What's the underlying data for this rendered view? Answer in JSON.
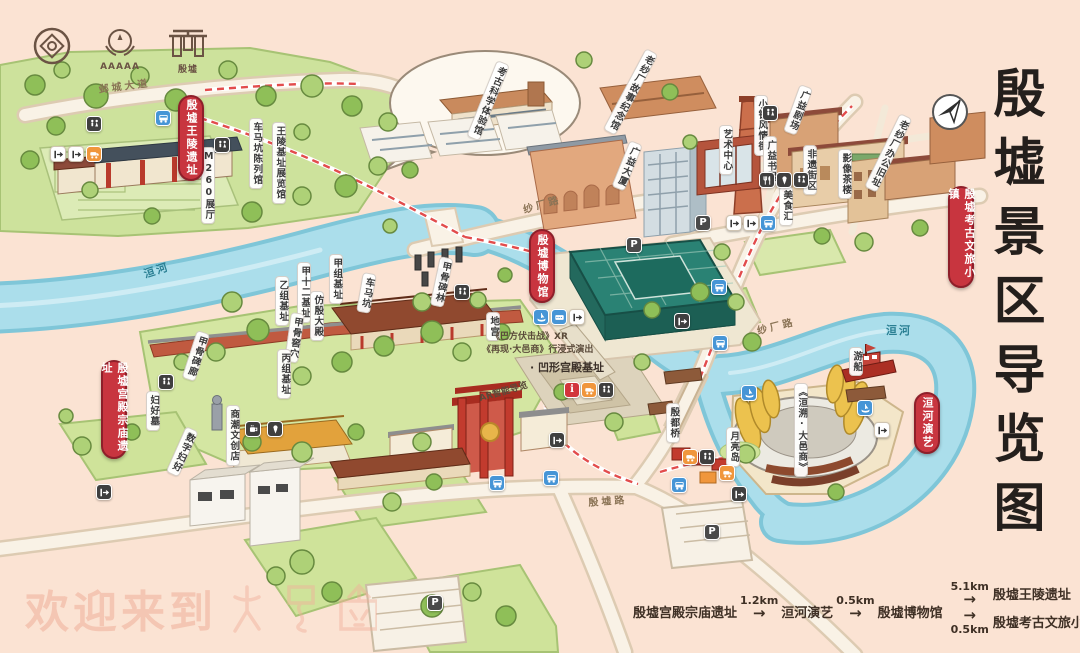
{
  "title": {
    "text": "殷墟景区导览图"
  },
  "logos": {
    "aaaaa": "AAAAA",
    "yinxu": "殷墟"
  },
  "badges": [
    {
      "id": "wangling",
      "text": "殷墟王陵遗址",
      "x": 178,
      "y": 95,
      "h": 82
    },
    {
      "id": "museum",
      "text": "殷墟博物馆",
      "x": 529,
      "y": 229,
      "h": 70
    },
    {
      "id": "town",
      "text": "殷墟考古文旅小镇",
      "x": 948,
      "y": 186,
      "h": 98
    },
    {
      "id": "palace",
      "text": "殷墟宫殿宗庙遗址",
      "x": 101,
      "y": 360,
      "h": 95
    },
    {
      "id": "show",
      "text": "洹河演艺",
      "x": 914,
      "y": 392,
      "h": 58
    }
  ],
  "map_labels": [
    {
      "text": "邺城大道",
      "x": 96,
      "y": 84,
      "mode": "road",
      "rot": -7
    },
    {
      "text": "车马坑陈列馆",
      "x": 249,
      "y": 118,
      "mode": "v"
    },
    {
      "text": "M260展厅",
      "x": 201,
      "y": 147,
      "mode": "v"
    },
    {
      "text": "王陵基址展览馆",
      "x": 272,
      "y": 122,
      "mode": "v"
    },
    {
      "text": "洹河",
      "x": 140,
      "y": 268,
      "mode": "river",
      "rot": -18
    },
    {
      "text": "甲组基址",
      "x": 329,
      "y": 254,
      "mode": "v"
    },
    {
      "text": "甲十二基址",
      "x": 297,
      "y": 262,
      "mode": "v"
    },
    {
      "text": "乙组基址",
      "x": 275,
      "y": 276,
      "mode": "v"
    },
    {
      "text": "仿殷大殿",
      "x": 310,
      "y": 291,
      "mode": "v"
    },
    {
      "text": "车马坑",
      "x": 363,
      "y": 272,
      "mode": "v",
      "rot": 10
    },
    {
      "text": "甲骨窖穴",
      "x": 291,
      "y": 312,
      "mode": "v",
      "rot": 8
    },
    {
      "text": "丙组基址",
      "x": 277,
      "y": 349,
      "mode": "v"
    },
    {
      "text": "甲骨碑林",
      "x": 440,
      "y": 256,
      "mode": "v",
      "rot": 12
    },
    {
      "text": "地宫",
      "x": 486,
      "y": 312,
      "mode": "v"
    },
    {
      "text": "《巴方伏击战》XR",
      "x": 489,
      "y": 331,
      "mode": "note"
    },
    {
      "text": "《再现·大邑商》行浸式演出",
      "x": 480,
      "y": 344,
      "mode": "note"
    },
    {
      "text": "· 凹形宫殿基址",
      "x": 528,
      "y": 360,
      "mode": "plain"
    },
    {
      "text": "AR智能导览",
      "x": 476,
      "y": 394,
      "mode": "note",
      "rot": -16
    },
    {
      "text": "甲骨碑廊",
      "x": 197,
      "y": 330,
      "mode": "v",
      "rot": 18
    },
    {
      "text": "妇好墓",
      "x": 146,
      "y": 391,
      "mode": "v"
    },
    {
      "text": "数字妇好",
      "x": 186,
      "y": 426,
      "mode": "v",
      "rot": 24
    },
    {
      "text": "商潮文创店",
      "x": 226,
      "y": 405,
      "mode": "v"
    },
    {
      "text": "纱厂路",
      "x": 520,
      "y": 205,
      "mode": "road",
      "rot": -16
    },
    {
      "text": "殷墟路",
      "x": 586,
      "y": 497,
      "mode": "road",
      "rot": -4
    },
    {
      "text": "考古科学体验馆",
      "x": 497,
      "y": 60,
      "mode": "v",
      "rot": 22
    },
    {
      "text": "老纱厂故事纪念馆",
      "x": 646,
      "y": 48,
      "mode": "v",
      "rot": 28
    },
    {
      "text": "广益大厦",
      "x": 630,
      "y": 140,
      "mode": "v",
      "rot": 22
    },
    {
      "text": "小镇风情街",
      "x": 754,
      "y": 95,
      "mode": "v"
    },
    {
      "text": "广益剧场",
      "x": 800,
      "y": 84,
      "mode": "v",
      "rot": 20
    },
    {
      "text": "艺术中心",
      "x": 719,
      "y": 125,
      "mode": "v"
    },
    {
      "text": "广益书屋",
      "x": 763,
      "y": 136,
      "mode": "v"
    },
    {
      "text": "非遗街区",
      "x": 803,
      "y": 145,
      "mode": "v"
    },
    {
      "text": "影像茶楼",
      "x": 838,
      "y": 149,
      "mode": "v"
    },
    {
      "text": "老纱厂办公旧址",
      "x": 900,
      "y": 113,
      "mode": "v",
      "rot": 26
    },
    {
      "text": "美食汇",
      "x": 779,
      "y": 186,
      "mode": "v"
    },
    {
      "text": "纱厂路",
      "x": 754,
      "y": 326,
      "mode": "road",
      "rot": -14
    },
    {
      "text": "洹河",
      "x": 884,
      "y": 323,
      "mode": "river"
    },
    {
      "text": "游船",
      "x": 849,
      "y": 347,
      "mode": "v"
    },
    {
      "text": "《洹溯·大邑商》",
      "x": 794,
      "y": 383,
      "mode": "v"
    },
    {
      "text": "月亮岛",
      "x": 726,
      "y": 427,
      "mode": "v"
    },
    {
      "text": "殷都桥",
      "x": 666,
      "y": 403,
      "mode": "v"
    }
  ],
  "icons": [
    {
      "type": "wc",
      "x": 86,
      "y": 116
    },
    {
      "type": "gate",
      "x": 50,
      "y": 146,
      "variant": "light"
    },
    {
      "type": "gate",
      "x": 68,
      "y": 146,
      "variant": "light"
    },
    {
      "type": "shuttle",
      "x": 86,
      "y": 146
    },
    {
      "type": "bus",
      "x": 155,
      "y": 110
    },
    {
      "type": "wc",
      "x": 214,
      "y": 137
    },
    {
      "type": "parking",
      "x": 626,
      "y": 237
    },
    {
      "type": "wc",
      "x": 454,
      "y": 284
    },
    {
      "type": "boat",
      "x": 533,
      "y": 309
    },
    {
      "type": "ticket",
      "x": 551,
      "y": 309
    },
    {
      "type": "gate",
      "x": 569,
      "y": 309,
      "variant": "light"
    },
    {
      "type": "gate",
      "x": 674,
      "y": 313,
      "variant": "dark"
    },
    {
      "type": "wc",
      "x": 158,
      "y": 374
    },
    {
      "type": "coffee",
      "x": 245,
      "y": 421
    },
    {
      "type": "dessert",
      "x": 267,
      "y": 421
    },
    {
      "type": "info",
      "x": 564,
      "y": 382
    },
    {
      "type": "shuttle",
      "x": 581,
      "y": 382
    },
    {
      "type": "wc",
      "x": 598,
      "y": 382
    },
    {
      "type": "gate",
      "x": 549,
      "y": 432,
      "variant": "dark"
    },
    {
      "type": "bus",
      "x": 543,
      "y": 470
    },
    {
      "type": "bus",
      "x": 489,
      "y": 475
    },
    {
      "type": "bus",
      "x": 711,
      "y": 279
    },
    {
      "type": "parking",
      "x": 695,
      "y": 215
    },
    {
      "type": "gate",
      "x": 726,
      "y": 215,
      "variant": "light"
    },
    {
      "type": "gate",
      "x": 743,
      "y": 215,
      "variant": "light"
    },
    {
      "type": "bus",
      "x": 760,
      "y": 215
    },
    {
      "type": "wc",
      "x": 762,
      "y": 105
    },
    {
      "type": "food",
      "x": 759,
      "y": 172
    },
    {
      "type": "dessert",
      "x": 776,
      "y": 172
    },
    {
      "type": "wc",
      "x": 793,
      "y": 172
    },
    {
      "type": "bus",
      "x": 712,
      "y": 335
    },
    {
      "type": "boat",
      "x": 741,
      "y": 385
    },
    {
      "type": "boat",
      "x": 857,
      "y": 400
    },
    {
      "type": "gate",
      "x": 874,
      "y": 422,
      "variant": "light"
    },
    {
      "type": "shuttle",
      "x": 682,
      "y": 449
    },
    {
      "type": "wc",
      "x": 699,
      "y": 449
    },
    {
      "type": "shuttle",
      "x": 719,
      "y": 465
    },
    {
      "type": "bus",
      "x": 671,
      "y": 477
    },
    {
      "type": "gate",
      "x": 731,
      "y": 486,
      "variant": "dark"
    },
    {
      "type": "parking",
      "x": 704,
      "y": 524
    },
    {
      "type": "parking",
      "x": 427,
      "y": 595
    },
    {
      "type": "gate",
      "x": 96,
      "y": 484,
      "variant": "dark"
    }
  ],
  "route_bar": {
    "arrow": "→",
    "stop1": "殷墟宫殿宗庙遗址",
    "dist1": "1.2km",
    "stop2": "洹河演艺",
    "dist2": "0.5km",
    "stop3": "殷墟博物馆",
    "dist3": "5.1km",
    "branch1": "殷墟王陵遗址",
    "dist4": "0.5km",
    "branch2": "殷墟考古文旅小镇"
  },
  "watermark": {
    "text": "欢迎来到",
    "glyphs": "大邑商"
  }
}
